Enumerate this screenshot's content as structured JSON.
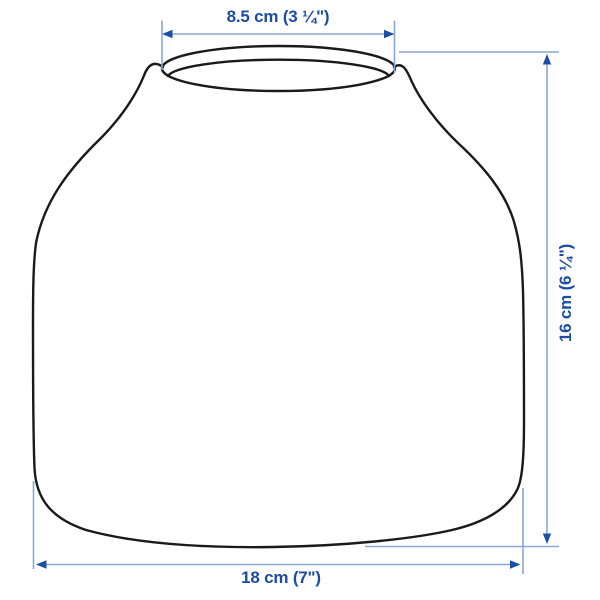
{
  "diagram": {
    "product": "vase",
    "view": "front-outline-with-measurements",
    "dimensions": {
      "opening_width": {
        "label": "8.5 cm (3 ¼\")",
        "value_cm": 8.5,
        "position": "top"
      },
      "height": {
        "label": "16 cm (6 ¼\")",
        "value_cm": 16,
        "position": "right"
      },
      "base_width": {
        "label": "18 cm (7\")",
        "value_cm": 18,
        "position": "bottom"
      }
    },
    "colors": {
      "label_text": "#1c4ca4",
      "arrowhead": "#1d4ea6",
      "dimension_line": "#8ba6d4",
      "outline": "#1a1a1a",
      "background": "#ffffff"
    }
  }
}
